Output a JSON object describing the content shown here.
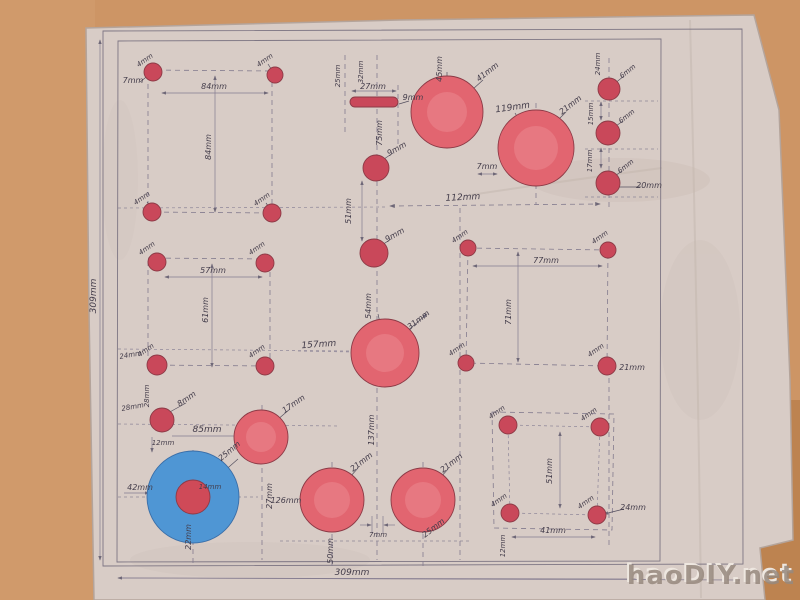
{
  "scene": {
    "description_title": "hand-drawn hole layout plan on paper",
    "watermark": "haoDIY.net"
  },
  "colors": {
    "wall": "#cd9565",
    "wall_dark": "#b1753f",
    "paper": "#d8ccc6",
    "paper_shade": "#cabbb4",
    "pencil": "#7d7583",
    "ink": "#433c4a",
    "hole_red": "#c9485a",
    "disc_red": "#e26570",
    "disc_red_light": "#f0959b",
    "disc_blue": "#4f96d4",
    "hub_red": "#cf4a58",
    "watermark_gray": "#97897e"
  },
  "labels": {
    "mm4": "4mm",
    "mm6": "6mm",
    "mm7": "7mm",
    "mm8": "8mm",
    "mm9": "9mm",
    "mm12": "12mm",
    "mm14": "14mm",
    "mm15": "15mm",
    "mm17": "17mm",
    "mm20": "20mm",
    "mm21": "21mm",
    "mm22": "22mm",
    "mm24": "24mm",
    "mm25": "25mm",
    "mm27": "27mm",
    "mm28": "28mm",
    "mm31": "31mm",
    "mm32": "32mm",
    "mm41": "41mm",
    "mm42": "42mm",
    "mm45": "45mm",
    "mm50": "50mm",
    "mm51": "51mm",
    "mm54": "54mm",
    "mm57": "57mm",
    "mm61": "61mm",
    "mm71": "71mm",
    "mm75": "75mm",
    "mm77": "77mm",
    "mm84": "84mm",
    "mm85": "85mm",
    "mm112": "112mm",
    "mm119": "119mm",
    "mm126": "126mm",
    "mm137": "137mm",
    "mm157": "157mm",
    "mm309": "309mm",
    "watermark": "haoDIY.net"
  }
}
